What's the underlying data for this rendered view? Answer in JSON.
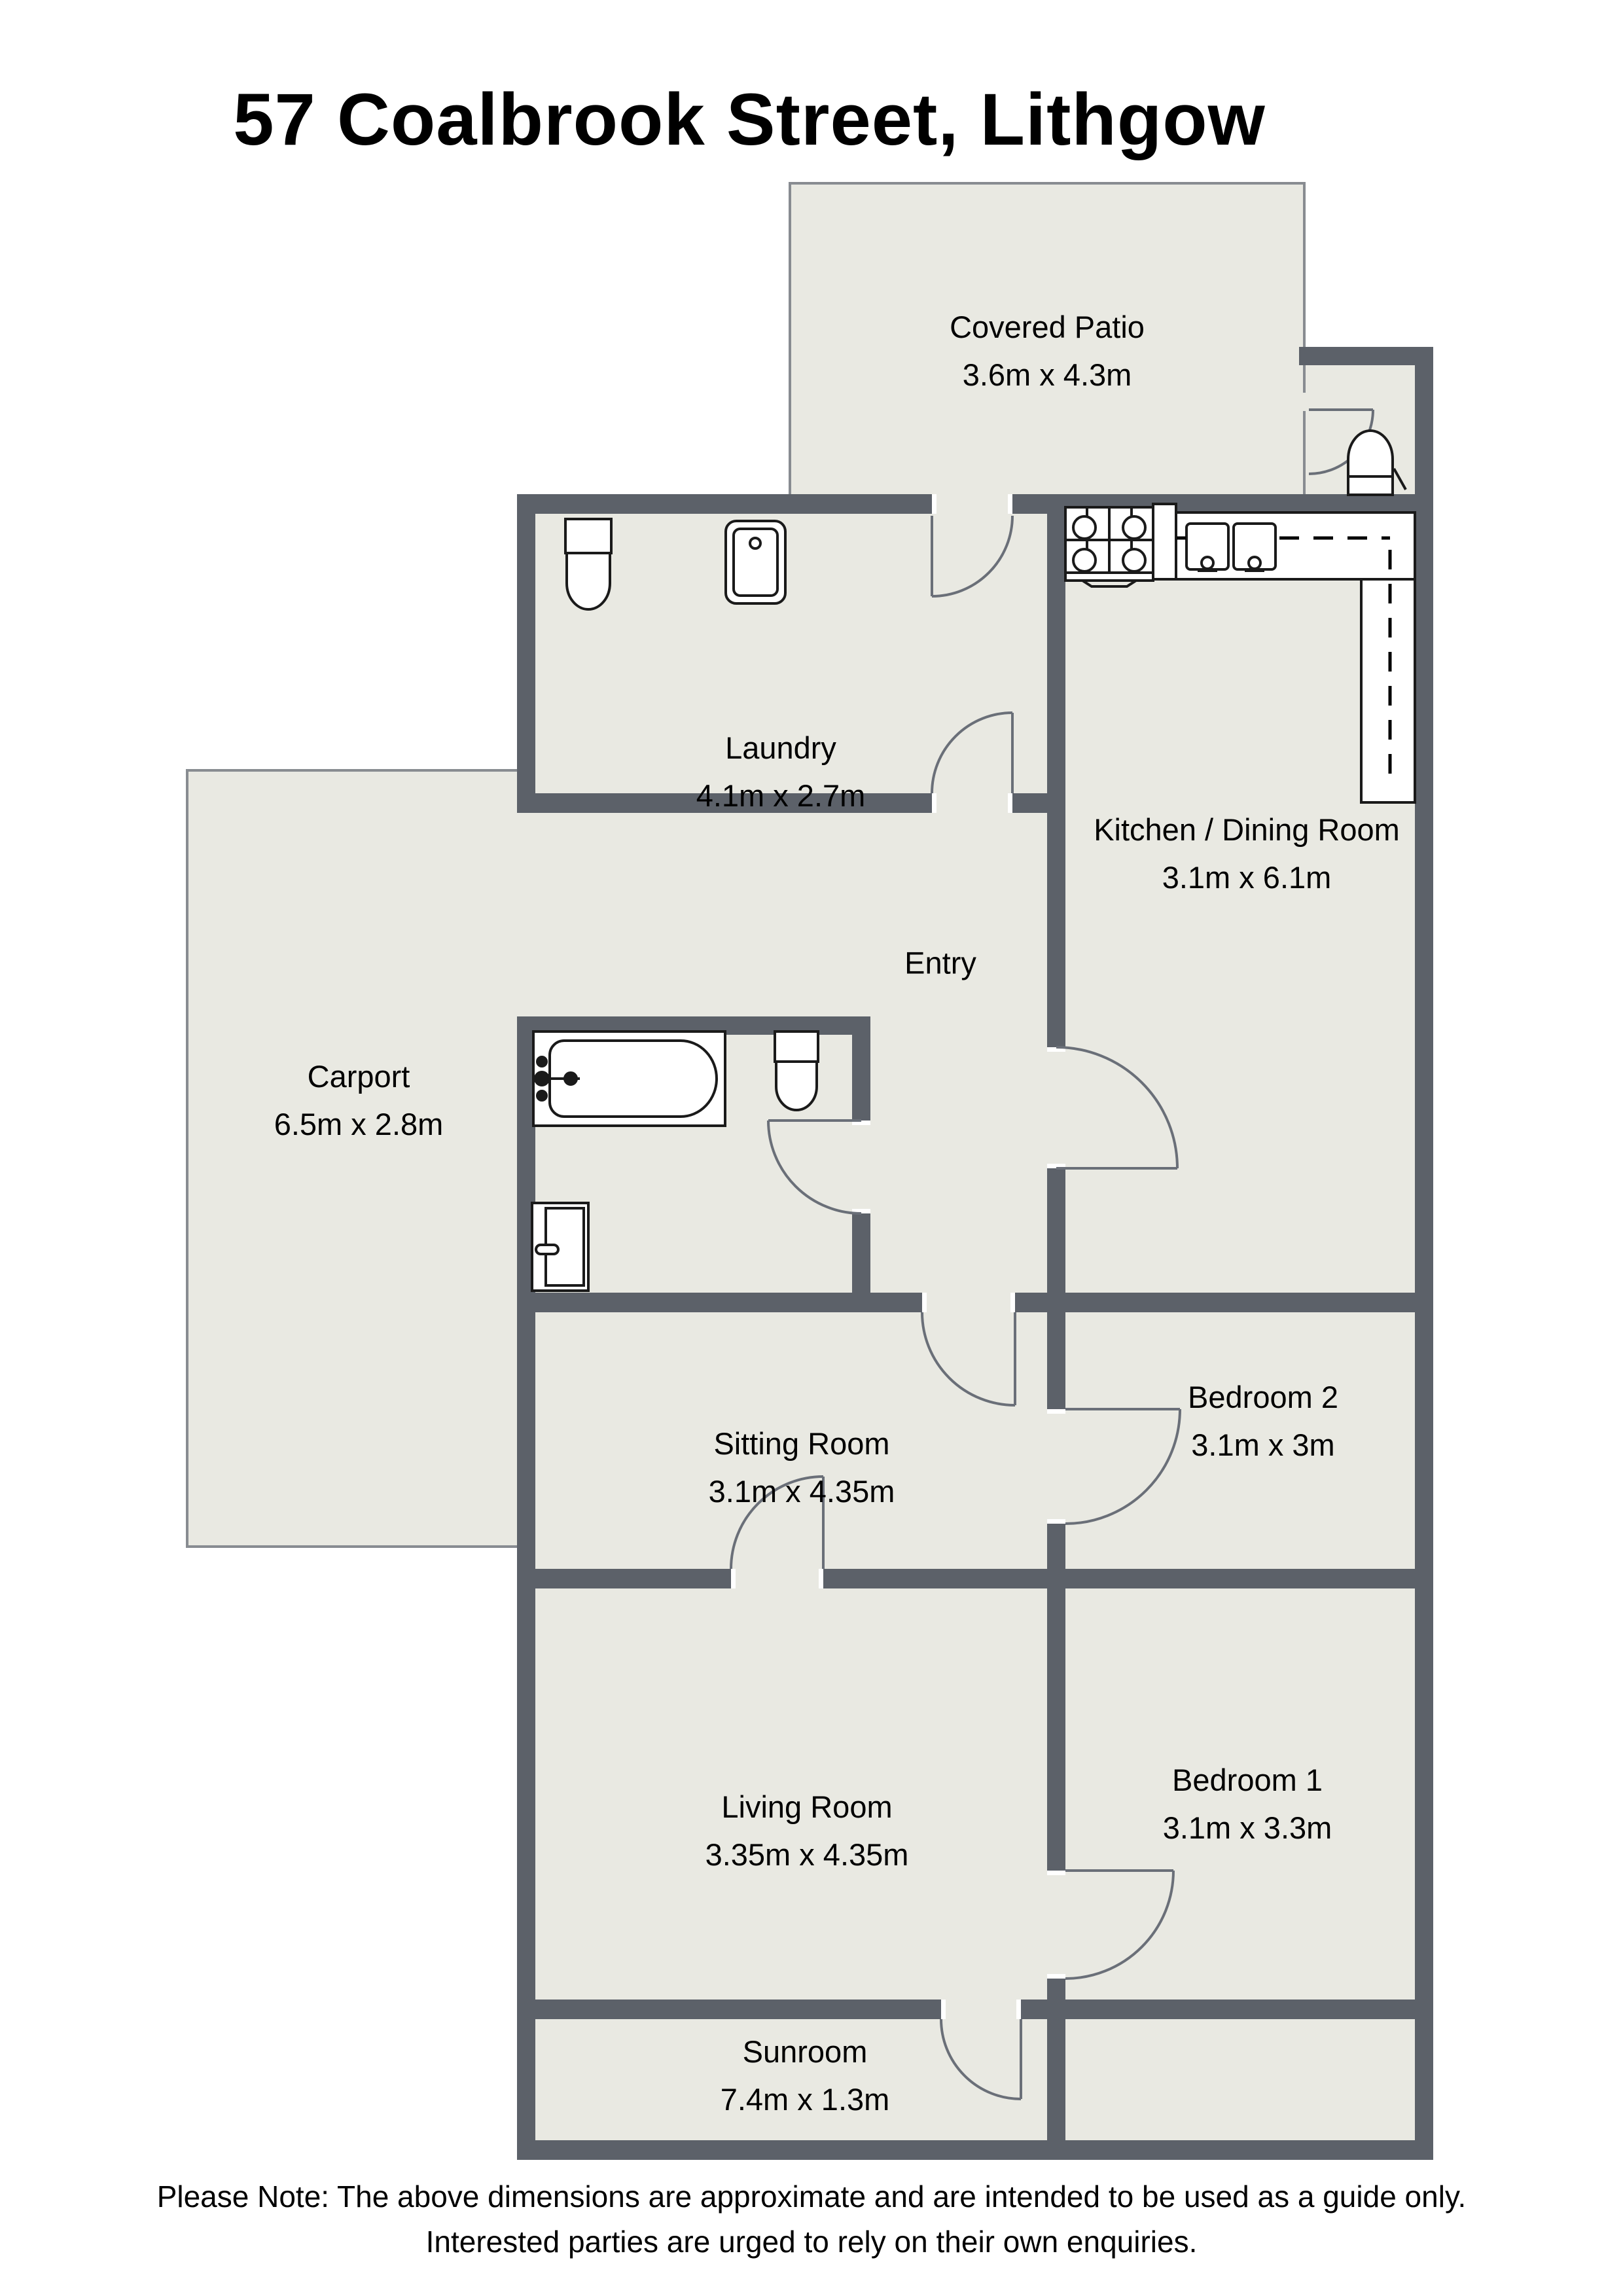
{
  "title": "57 Coalbrook Street, Lithgow",
  "rooms": {
    "covered_patio": {
      "name": "Covered Patio",
      "dims": "3.6m x 4.3m"
    },
    "laundry": {
      "name": "Laundry",
      "dims": "4.1m x 2.7m"
    },
    "kitchen_dining": {
      "name": "Kitchen / Dining Room",
      "dims": "3.1m x 6.1m"
    },
    "carport": {
      "name": "Carport",
      "dims": "6.5m x 2.8m"
    },
    "entry": {
      "name": "Entry",
      "dims": ""
    },
    "sitting_room": {
      "name": "Sitting Room",
      "dims": "3.1m x 4.35m"
    },
    "bedroom2": {
      "name": "Bedroom 2",
      "dims": "3.1m x 3m"
    },
    "living_room": {
      "name": "Living Room",
      "dims": "3.35m x 4.35m"
    },
    "bedroom1": {
      "name": "Bedroom 1",
      "dims": "3.1m x 3.3m"
    },
    "sunroom": {
      "name": "Sunroom",
      "dims": "7.4m x 1.3m"
    }
  },
  "footer": {
    "line1": "Please Note: The above dimensions are approximate and are intended to be used as a guide only.",
    "line2": "Interested parties are urged to rely on their own enquiries."
  },
  "colors": {
    "wall": "#5c6169",
    "room_fill": "#e9e9e2",
    "thin_outline": "#888c91",
    "fixture_line": "#1a1a1a",
    "door_arc": "#6a6f78",
    "text": "#000000"
  },
  "fixtures": [
    "toilet",
    "laundry-tub",
    "bathtub",
    "shower",
    "stove-cooktop",
    "kitchen-sink",
    "kitchen-bench",
    "overhead-cupboards",
    "water-heater"
  ]
}
